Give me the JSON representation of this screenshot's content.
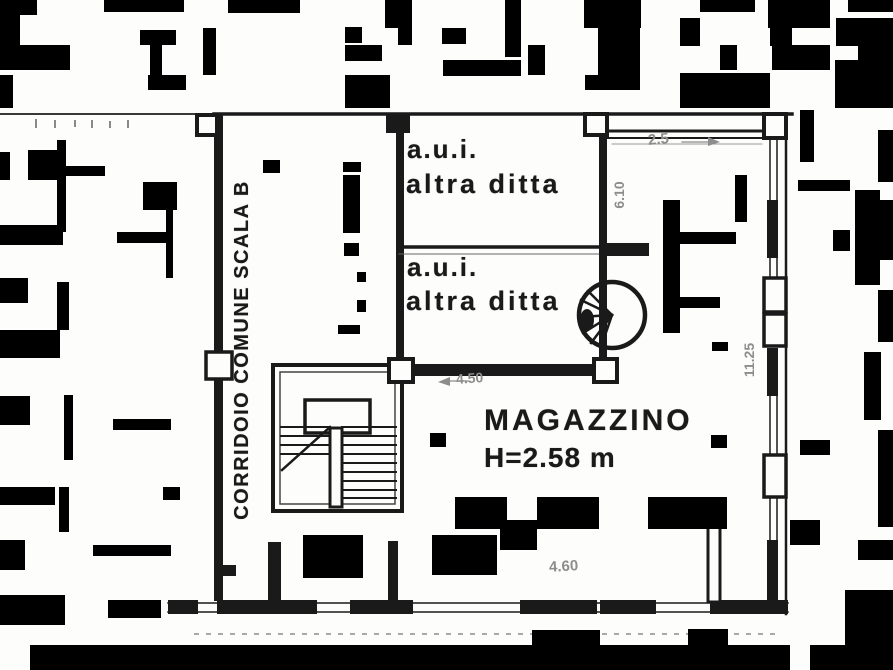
{
  "plan": {
    "corridor_label": "CORRIDOIO COMUNE SCALA B",
    "rooms": [
      {
        "line1": "a.u.i.",
        "line2": "altra ditta"
      },
      {
        "line1": "a.u.i.",
        "line2": "altra ditta"
      }
    ],
    "magazzino": {
      "name": "MAGAZZINO",
      "height_label": "H=2.58 m"
    },
    "dimensions": {
      "top_right_width": "2.5",
      "room2_width": "4.50",
      "bottom_width": "4.60",
      "right_height": "11.25",
      "inner_wall_vertical": "6.10"
    },
    "colors": {
      "ink": "#1a1a1a",
      "dim_ink": "#8d8d8d",
      "paper": "#fdfdfc"
    }
  }
}
